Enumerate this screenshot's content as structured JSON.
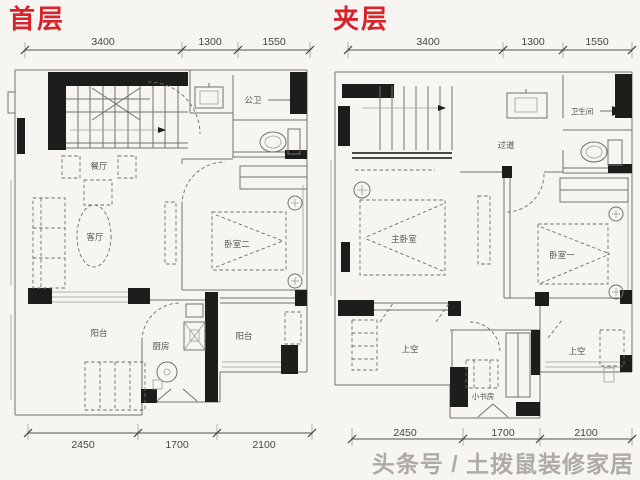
{
  "page": {
    "background": "#f6f5f2",
    "watermark": "头条号 / 土拨鼠装修家居"
  },
  "colors": {
    "title_red": "#d8232a",
    "line_gray": "#72716c",
    "wall_black": "#1d1d1c",
    "watermark_gray": "#a39e98"
  },
  "plans": {
    "first": {
      "title": "首层",
      "dims_top": [
        "3400",
        "1300",
        "1550"
      ],
      "dims_bottom": [
        "2450",
        "1700",
        "2100"
      ],
      "labels": {
        "dining": "餐厅",
        "living": "客厅",
        "public_bath": "公卫",
        "bedroom2": "卧室二",
        "balcony_left": "阳台",
        "kitchen": "厨房",
        "balcony_right": "阳台"
      }
    },
    "mezz": {
      "title": "夹层",
      "dims_top": [
        "3400",
        "1300",
        "1550"
      ],
      "dims_bottom": [
        "2450",
        "1700",
        "2100"
      ],
      "labels": {
        "corridor": "过道",
        "bathroom": "卫生间",
        "master": "主卧室",
        "bedroom1": "卧室一",
        "void_left": "上空",
        "void_right": "上空",
        "study": "小书房"
      }
    }
  }
}
